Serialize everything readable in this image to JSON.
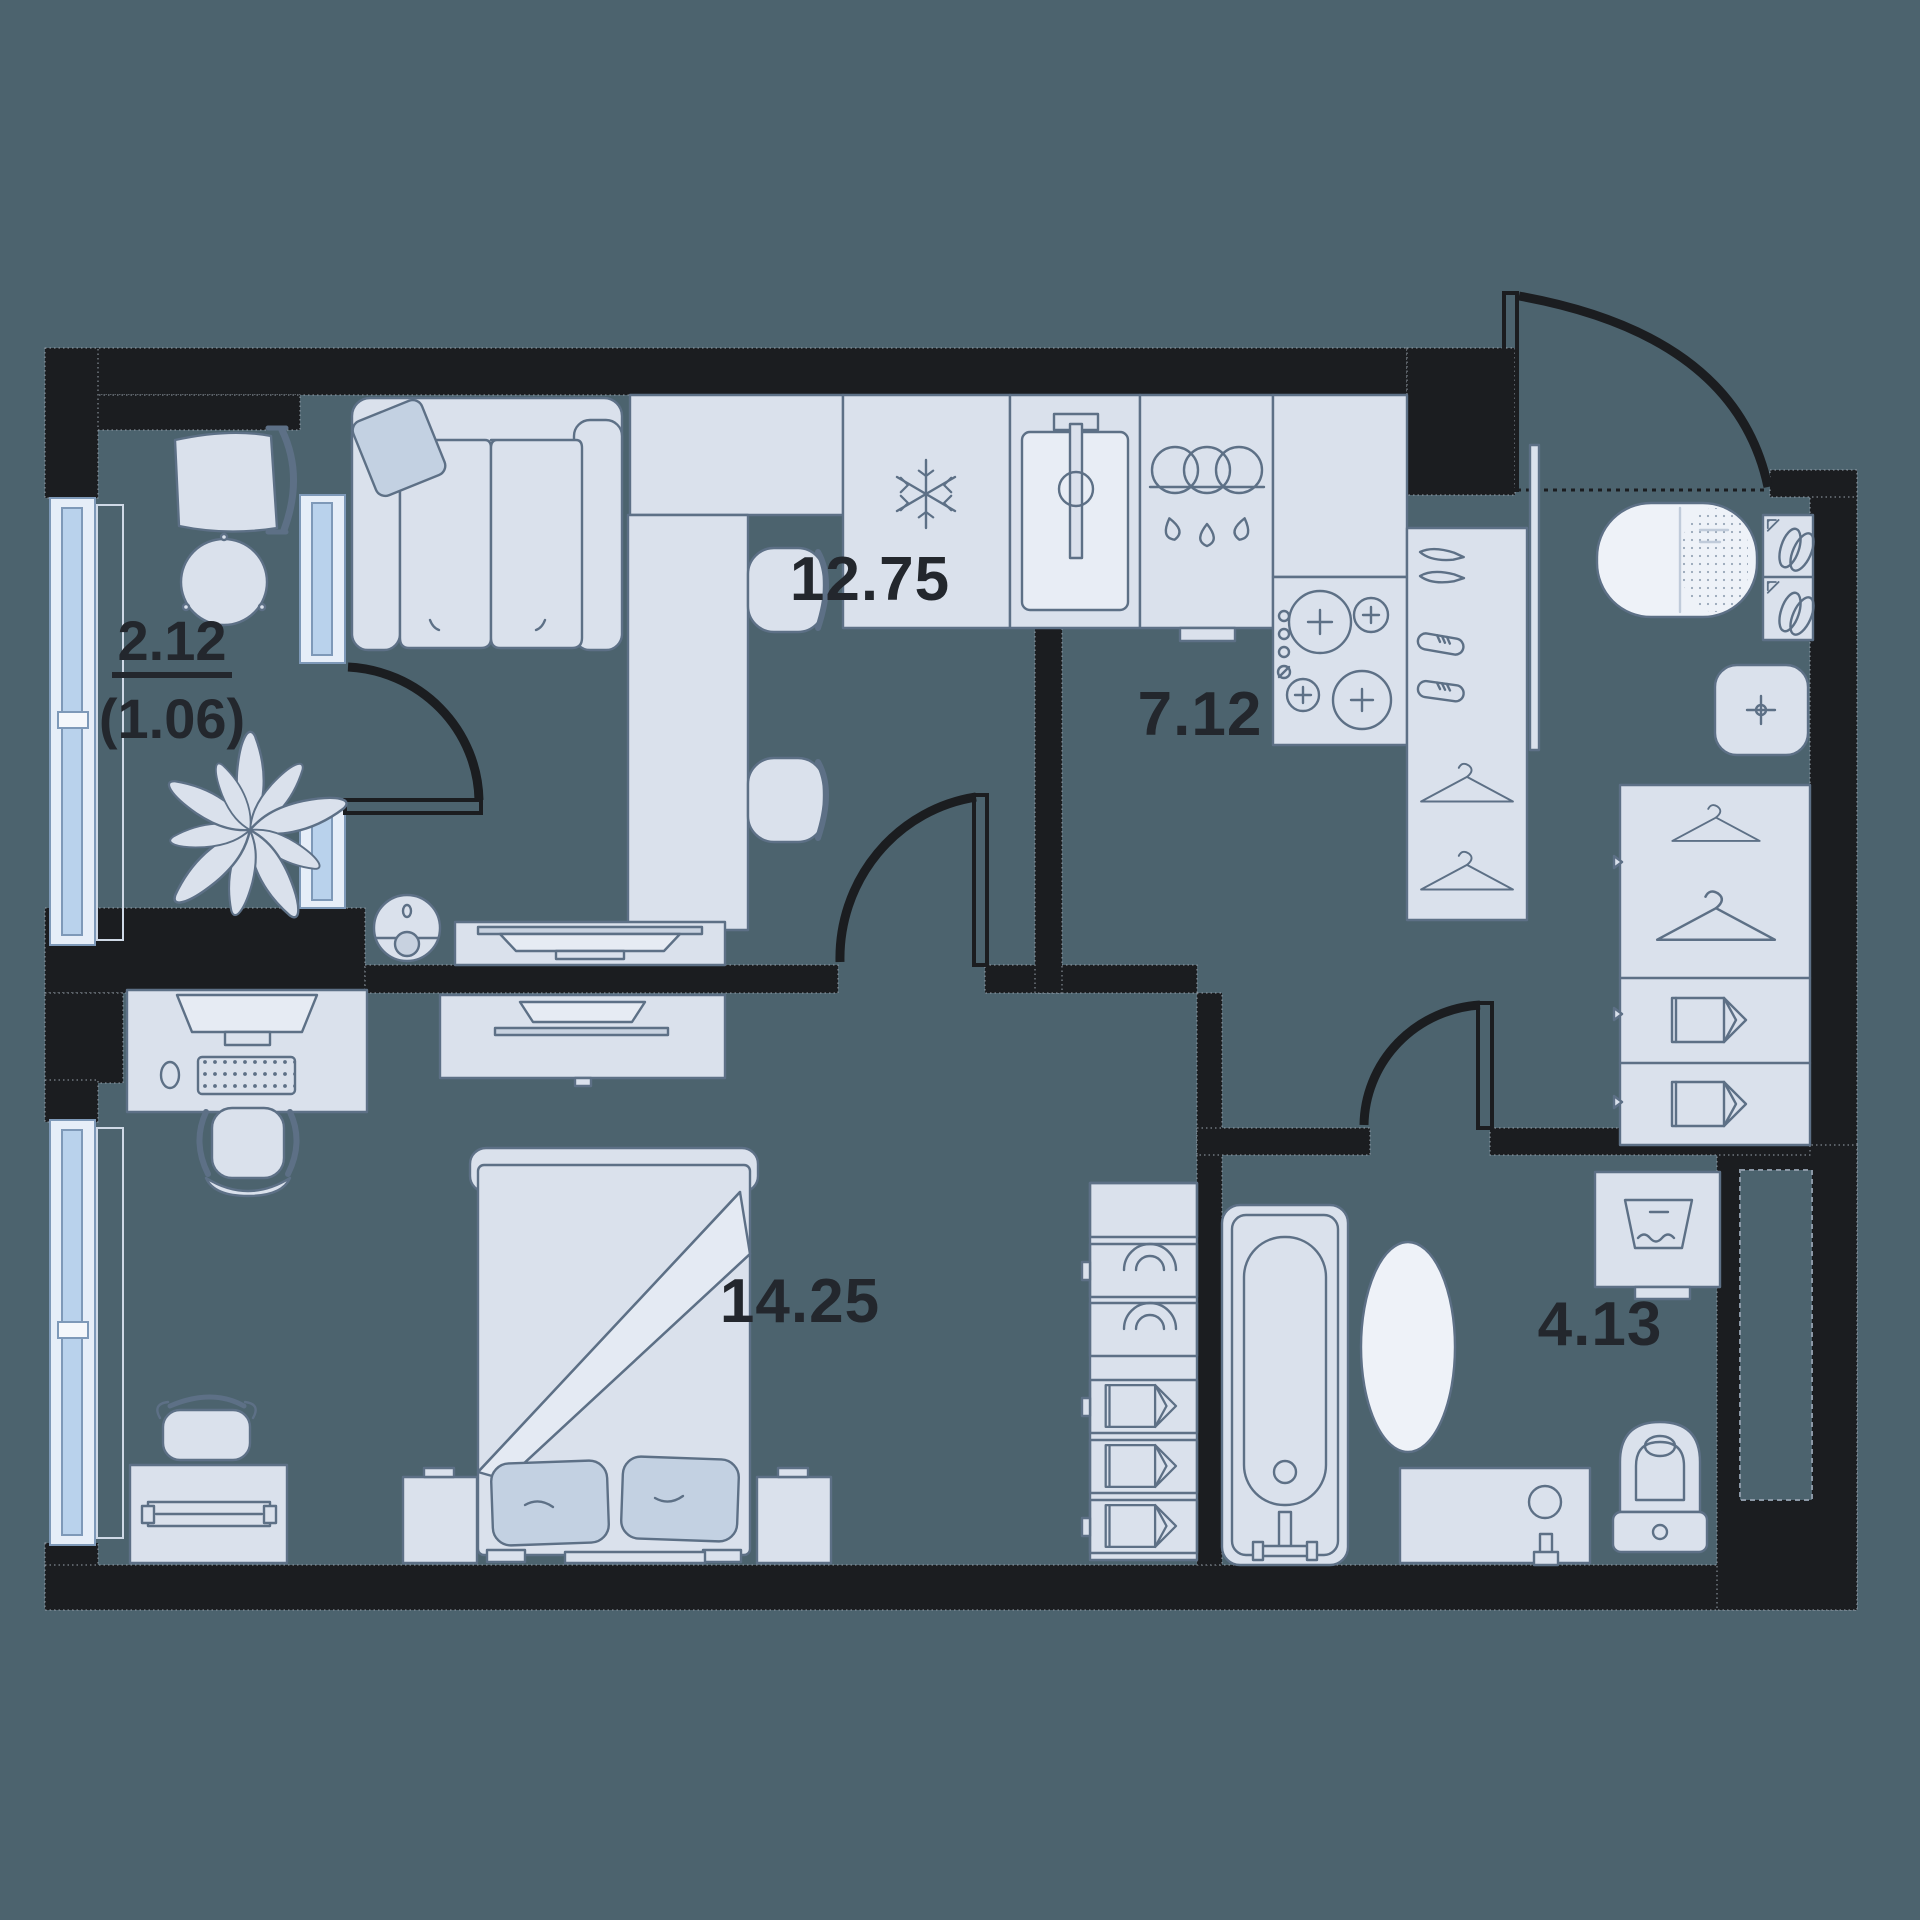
{
  "title": "apartment-floor-plan",
  "rooms": [
    {
      "name": "kitchen-living-room",
      "area_label": "12.75"
    },
    {
      "name": "hallway",
      "area_label": "7.12"
    },
    {
      "name": "bedroom",
      "area_label": "14.25"
    },
    {
      "name": "bathroom",
      "area_label": "4.13"
    },
    {
      "name": "balcony",
      "area_label": "2.12",
      "area_label_reduced": "(1.06)"
    }
  ],
  "colors": {
    "floor": "#4c636e",
    "wall": "#1b1d20",
    "furniture_fill": "#dae1ec",
    "furniture_fill_bright": "#eef2f8",
    "furniture_stroke": "#5d7086",
    "accent_pillow": "#c3d1e2",
    "window_frame": "#7e99b8",
    "window_glass": "#b9d2ec",
    "window_fill": "#e6eef8",
    "label_text": "#23272d",
    "wall_dot_edge": "#98a2ac"
  },
  "icons": [
    "snowflake-fridge-icon",
    "sink-tap-icon",
    "pots-rings-icon",
    "stove-burner-icon",
    "hanger-icon",
    "shoes-icon",
    "crosshair-icon",
    "washing-water-icon",
    "plant-icon",
    "tv-icon",
    "monitor-icon",
    "keyboard-icon",
    "robot-vacuum-icon"
  ]
}
